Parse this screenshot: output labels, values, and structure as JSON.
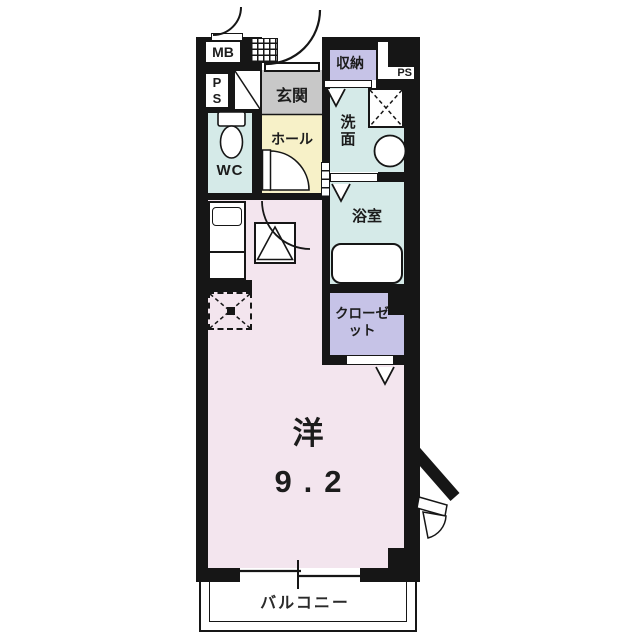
{
  "floorplan": {
    "title": "studio apartment floor plan",
    "labels": {
      "mb": "MB",
      "ps_left": "PS",
      "ps_right": "PS",
      "genkan": "玄関",
      "storage": "収納",
      "washroom": "洗面",
      "wc": "WC",
      "hall": "ホール",
      "bathroom": "浴室",
      "closet": "クローゼット",
      "room_type": "洋",
      "room_size": "9.2",
      "balcony": "バルコニー"
    },
    "colors": {
      "wall": "#161616",
      "main_room": "#f3e5ee",
      "wet_area": "#d5eae8",
      "hall": "#f7f1c8",
      "genkan": "#c8c8c8",
      "storage": "#c6c3e7",
      "fixtures": "#ffffff",
      "outside": "#ffffff"
    },
    "fixtures": [
      "toilet",
      "bathtub",
      "washbasin",
      "kitchen-sink",
      "stove",
      "refrigerator-space",
      "washing-machine-pan",
      "meter-box",
      "pipe-space",
      "shoe-cabinet",
      "sliding-window",
      "door-swings"
    ]
  }
}
